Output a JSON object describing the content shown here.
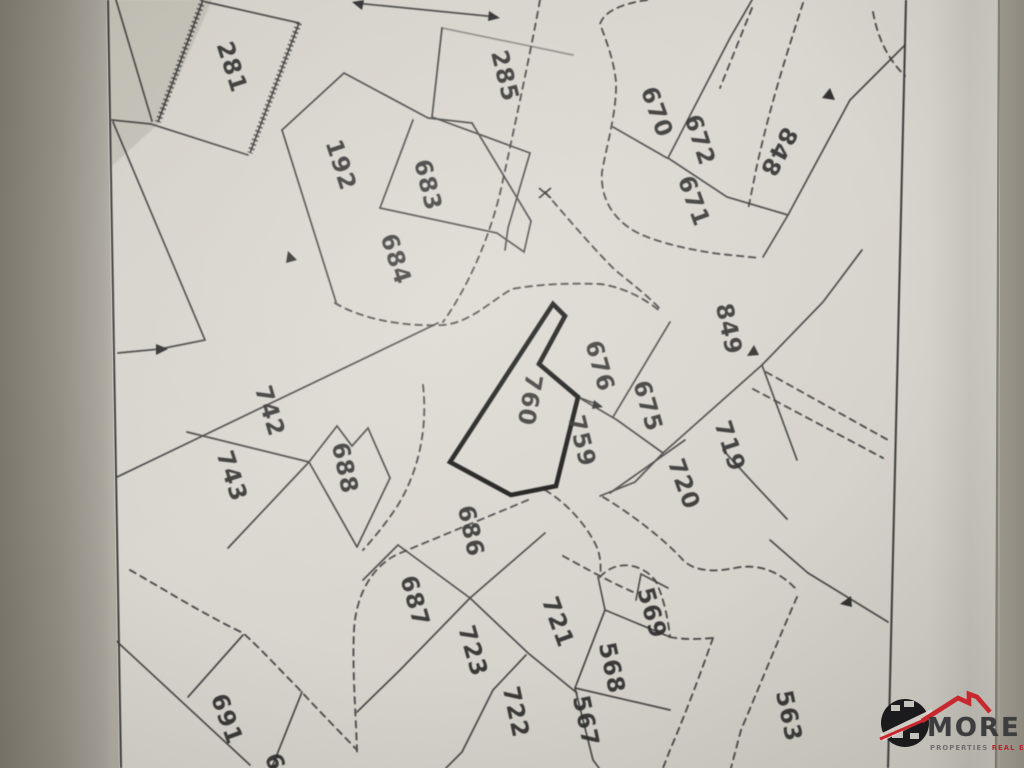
{
  "map": {
    "description": "photographed cadastral parcel plan",
    "highlighted_parcel": "760",
    "ink_color": "#3a3a3a",
    "bold_outline_color": "#161616",
    "paper_color": "#d8d5ce",
    "parcels": [
      {
        "num": "281",
        "x": 232,
        "y": 67,
        "rot": 72
      },
      {
        "num": "285",
        "x": 505,
        "y": 76,
        "rot": 76
      },
      {
        "num": "192",
        "x": 341,
        "y": 165,
        "rot": 72
      },
      {
        "num": "683",
        "x": 428,
        "y": 185,
        "rot": 76
      },
      {
        "num": "684",
        "x": 396,
        "y": 259,
        "rot": 72
      },
      {
        "num": "670",
        "x": 657,
        "y": 112,
        "rot": 70
      },
      {
        "num": "672",
        "x": 700,
        "y": 140,
        "rot": 72
      },
      {
        "num": "671",
        "x": 694,
        "y": 201,
        "rot": 70
      },
      {
        "num": "848",
        "x": 779,
        "y": 152,
        "rot": 118
      },
      {
        "num": "849",
        "x": 729,
        "y": 329,
        "rot": 78
      },
      {
        "num": "676",
        "x": 600,
        "y": 366,
        "rot": 74
      },
      {
        "num": "675",
        "x": 648,
        "y": 406,
        "rot": 74
      },
      {
        "num": "760",
        "x": 530,
        "y": 400,
        "rot": 100
      },
      {
        "num": "759",
        "x": 582,
        "y": 441,
        "rot": 76
      },
      {
        "num": "719",
        "x": 730,
        "y": 446,
        "rot": 72
      },
      {
        "num": "720",
        "x": 684,
        "y": 484,
        "rot": 70
      },
      {
        "num": "742",
        "x": 270,
        "y": 411,
        "rot": 73
      },
      {
        "num": "743",
        "x": 232,
        "y": 476,
        "rot": 72
      },
      {
        "num": "688",
        "x": 345,
        "y": 468,
        "rot": 78
      },
      {
        "num": "686",
        "x": 471,
        "y": 531,
        "rot": 78
      },
      {
        "num": "687",
        "x": 415,
        "y": 601,
        "rot": 74
      },
      {
        "num": "723",
        "x": 473,
        "y": 651,
        "rot": 74
      },
      {
        "num": "721",
        "x": 558,
        "y": 622,
        "rot": 70
      },
      {
        "num": "722",
        "x": 516,
        "y": 712,
        "rot": 78
      },
      {
        "num": "569",
        "x": 652,
        "y": 613,
        "rot": 74
      },
      {
        "num": "568",
        "x": 612,
        "y": 668,
        "rot": 78
      },
      {
        "num": "567",
        "x": 586,
        "y": 721,
        "rot": 78
      },
      {
        "num": "563",
        "x": 789,
        "y": 716,
        "rot": 78
      },
      {
        "num": "691",
        "x": 227,
        "y": 719,
        "rot": 70
      },
      {
        "num": "6",
        "x": 275,
        "y": 762,
        "rot": 72
      }
    ]
  },
  "watermark": {
    "brand": "MORE",
    "tagline_gray": "PROPERTIES",
    "tagline_red": "REAL ESTATES",
    "roof_color": "#c8272d",
    "circle_color": "#1b1b1d"
  }
}
